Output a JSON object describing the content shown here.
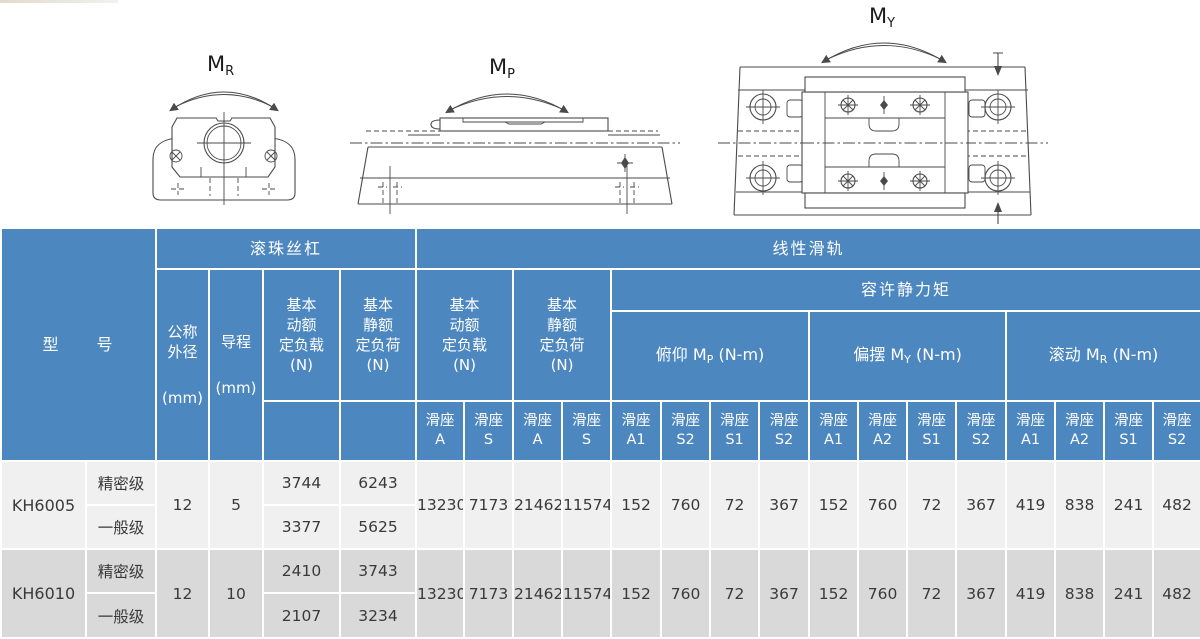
{
  "colors": {
    "header_blue": "#4d87c0",
    "row_light": "#f0f0f0",
    "row_dark": "#d9d9d9",
    "grid_line": "#ffffff",
    "data_text": "#3a3a3a",
    "line_dark": "#4a4a4a"
  },
  "diagrams": {
    "mr": {
      "label": "M",
      "sub": "R"
    },
    "mp": {
      "label": "M",
      "sub": "P"
    },
    "my": {
      "label": "M",
      "sub": "Y"
    }
  },
  "table": {
    "header": {
      "model": "型　　号",
      "ball_screw": "滚珠丝杠",
      "linear_guide": "线性滑轨",
      "nominal_od": "公称\n外径",
      "lead": "导程",
      "mm": "(mm)",
      "bs_dynamic": "基本\n动额\n定负载\n(N)",
      "bs_static": "基本\n静额\n定负荷\n(N)",
      "lg_dynamic": "基本\n动额\n定负载\n(N)",
      "lg_static": "基本\n静额\n定负荷\n(N)",
      "static_moment": "容许静力矩",
      "moments": [
        {
          "name": "俯仰",
          "m": "M",
          "sub": "P",
          "unit": "(N-m)"
        },
        {
          "name": "偏摆",
          "m": "M",
          "sub": "Y",
          "unit": "(N-m)"
        },
        {
          "name": "滚动",
          "m": "M",
          "sub": "R",
          "unit": "(N-m)"
        }
      ],
      "slider_label": "滑座",
      "slider_cols": [
        "A",
        "S",
        "A",
        "S",
        "A1",
        "S2",
        "S1",
        "S2",
        "A1",
        "A2",
        "S1",
        "S2",
        "A1",
        "A2",
        "S1",
        "S2"
      ]
    },
    "rows": [
      {
        "model": "KH6005",
        "od": "12",
        "lead": "5",
        "grades": [
          {
            "grade": "精密级",
            "dynamic": "3744",
            "static": "6243"
          },
          {
            "grade": "一般级",
            "dynamic": "3377",
            "static": "5625"
          }
        ],
        "shared": [
          "13230",
          "7173",
          "21462",
          "11574",
          "152",
          "760",
          "72",
          "367",
          "152",
          "760",
          "72",
          "367",
          "419",
          "838",
          "241",
          "482"
        ]
      },
      {
        "model": "KH6010",
        "od": "12",
        "lead": "10",
        "grades": [
          {
            "grade": "精密级",
            "dynamic": "2410",
            "static": "3743"
          },
          {
            "grade": "一般级",
            "dynamic": "2107",
            "static": "3234"
          }
        ],
        "shared": [
          "13230",
          "7173",
          "21462",
          "11574",
          "152",
          "760",
          "72",
          "367",
          "152",
          "760",
          "72",
          "367",
          "419",
          "838",
          "241",
          "482"
        ]
      }
    ]
  }
}
